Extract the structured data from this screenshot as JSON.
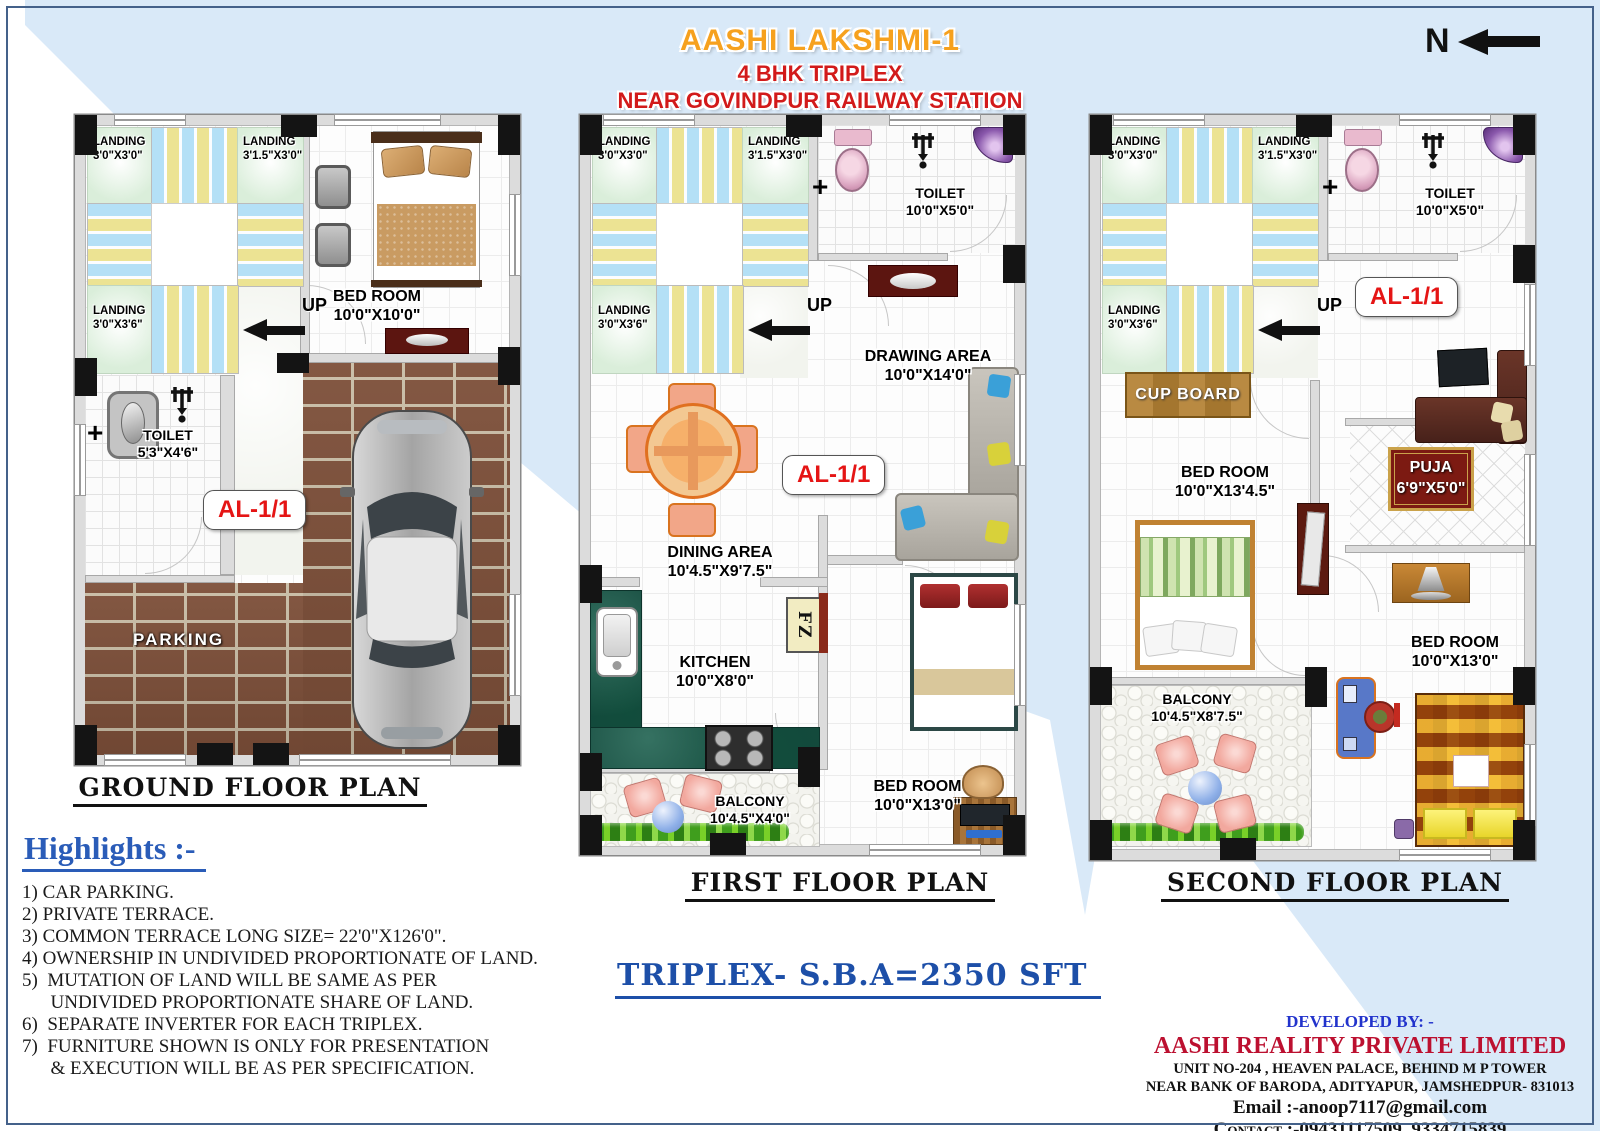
{
  "header": {
    "title": "AASHI LAKSHMI-1",
    "subtitle": "4 BHK TRIPLEX",
    "location": "NEAR GOVINDPUR RAILWAY STATION",
    "title_color": "#F6A11E",
    "subtitle_color": "#D21A1A"
  },
  "compass": {
    "label": "N"
  },
  "markers": {
    "door_plus": "+"
  },
  "stairs": {
    "landing_a_name": "LANDING",
    "landing_a_dim": "3'0\"X3'0\"",
    "landing_b_name": "LANDING",
    "landing_b_dim": "3'1.5\"X3'0\"",
    "landing_c_name": "LANDING",
    "landing_c_dim": "3'0\"X3'6\"",
    "up_label": "UP"
  },
  "badge": {
    "unit": "AL-1/1"
  },
  "plans": {
    "ground": {
      "title": "GROUND FLOOR PLAN",
      "toilet_name": "TOILET",
      "toilet_dim": "5'3\"X4'6\"",
      "bedroom_name": "BED ROOM",
      "bedroom_dim": "10'0\"X10'0\"",
      "parking_label": "PARKING"
    },
    "first": {
      "title": "FIRST FLOOR PLAN",
      "toilet_name": "TOILET",
      "toilet_dim": "10'0\"X5'0\"",
      "drawing_name": "DRAWING AREA",
      "drawing_dim": "10'0\"X14'0\"",
      "dining_name": "DINING AREA",
      "dining_dim": "10'4.5\"X9'7.5\"",
      "kitchen_name": "KITCHEN",
      "kitchen_dim": "10'0\"X8'0\"",
      "freezer_label": "FZ",
      "bedroom_name": "BED ROOM",
      "bedroom_dim": "10'0\"X13'0\"",
      "balcony_name": "BALCONY",
      "balcony_dim": "10'4.5\"X4'0\""
    },
    "second": {
      "title": "SECOND FLOOR PLAN",
      "toilet_name": "TOILET",
      "toilet_dim": "10'0\"X5'0\"",
      "cupboard_label": "CUP BOARD",
      "bedroom1_name": "BED ROOM",
      "bedroom1_dim": "10'0\"X13'4.5\"",
      "puja_name": "PUJA",
      "puja_dim": "6'9\"X5'0\"",
      "bedroom2_name": "BED ROOM",
      "bedroom2_dim": "10'0\"X13'0\"",
      "balcony_name": "BALCONY",
      "balcony_dim": "10'4.5\"X8'7.5\""
    }
  },
  "summary": {
    "sba_text": "TRIPLEX- S.B.A=2350 SFT"
  },
  "highlights": {
    "heading": "Highlights :-",
    "items": [
      "1) CAR PARKING.",
      "2) PRIVATE TERRACE.",
      "3) COMMON TERRACE LONG SIZE= 22'0\"X126'0\".",
      "4) OWNERSHIP IN UNDIVIDED PROPORTIONATE OF LAND.",
      "5)  MUTATION OF LAND WILL BE SAME AS PER",
      "      UNDIVIDED PROPORTIONATE SHARE OF LAND.",
      "6)  SEPARATE INVERTER FOR EACH TRIPLEX.",
      "7)  FURNITURE SHOWN IS ONLY FOR PRESENTATION",
      "      & EXECUTION WILL BE AS PER SPECIFICATION."
    ]
  },
  "developer": {
    "heading": "DEVELOPED BY: -",
    "company": "AASHI REALITY PRIVATE LIMITED",
    "address_line1": "UNIT NO-204 , HEAVEN PALACE, BEHIND M P TOWER",
    "address_line2": "NEAR BANK OF BARODA, ADITYAPUR, JAMSHEDPUR- 831013",
    "email": "Email :-anoop7117@gmail.com",
    "contact": "Contact :-09431117509, 9334715839"
  }
}
